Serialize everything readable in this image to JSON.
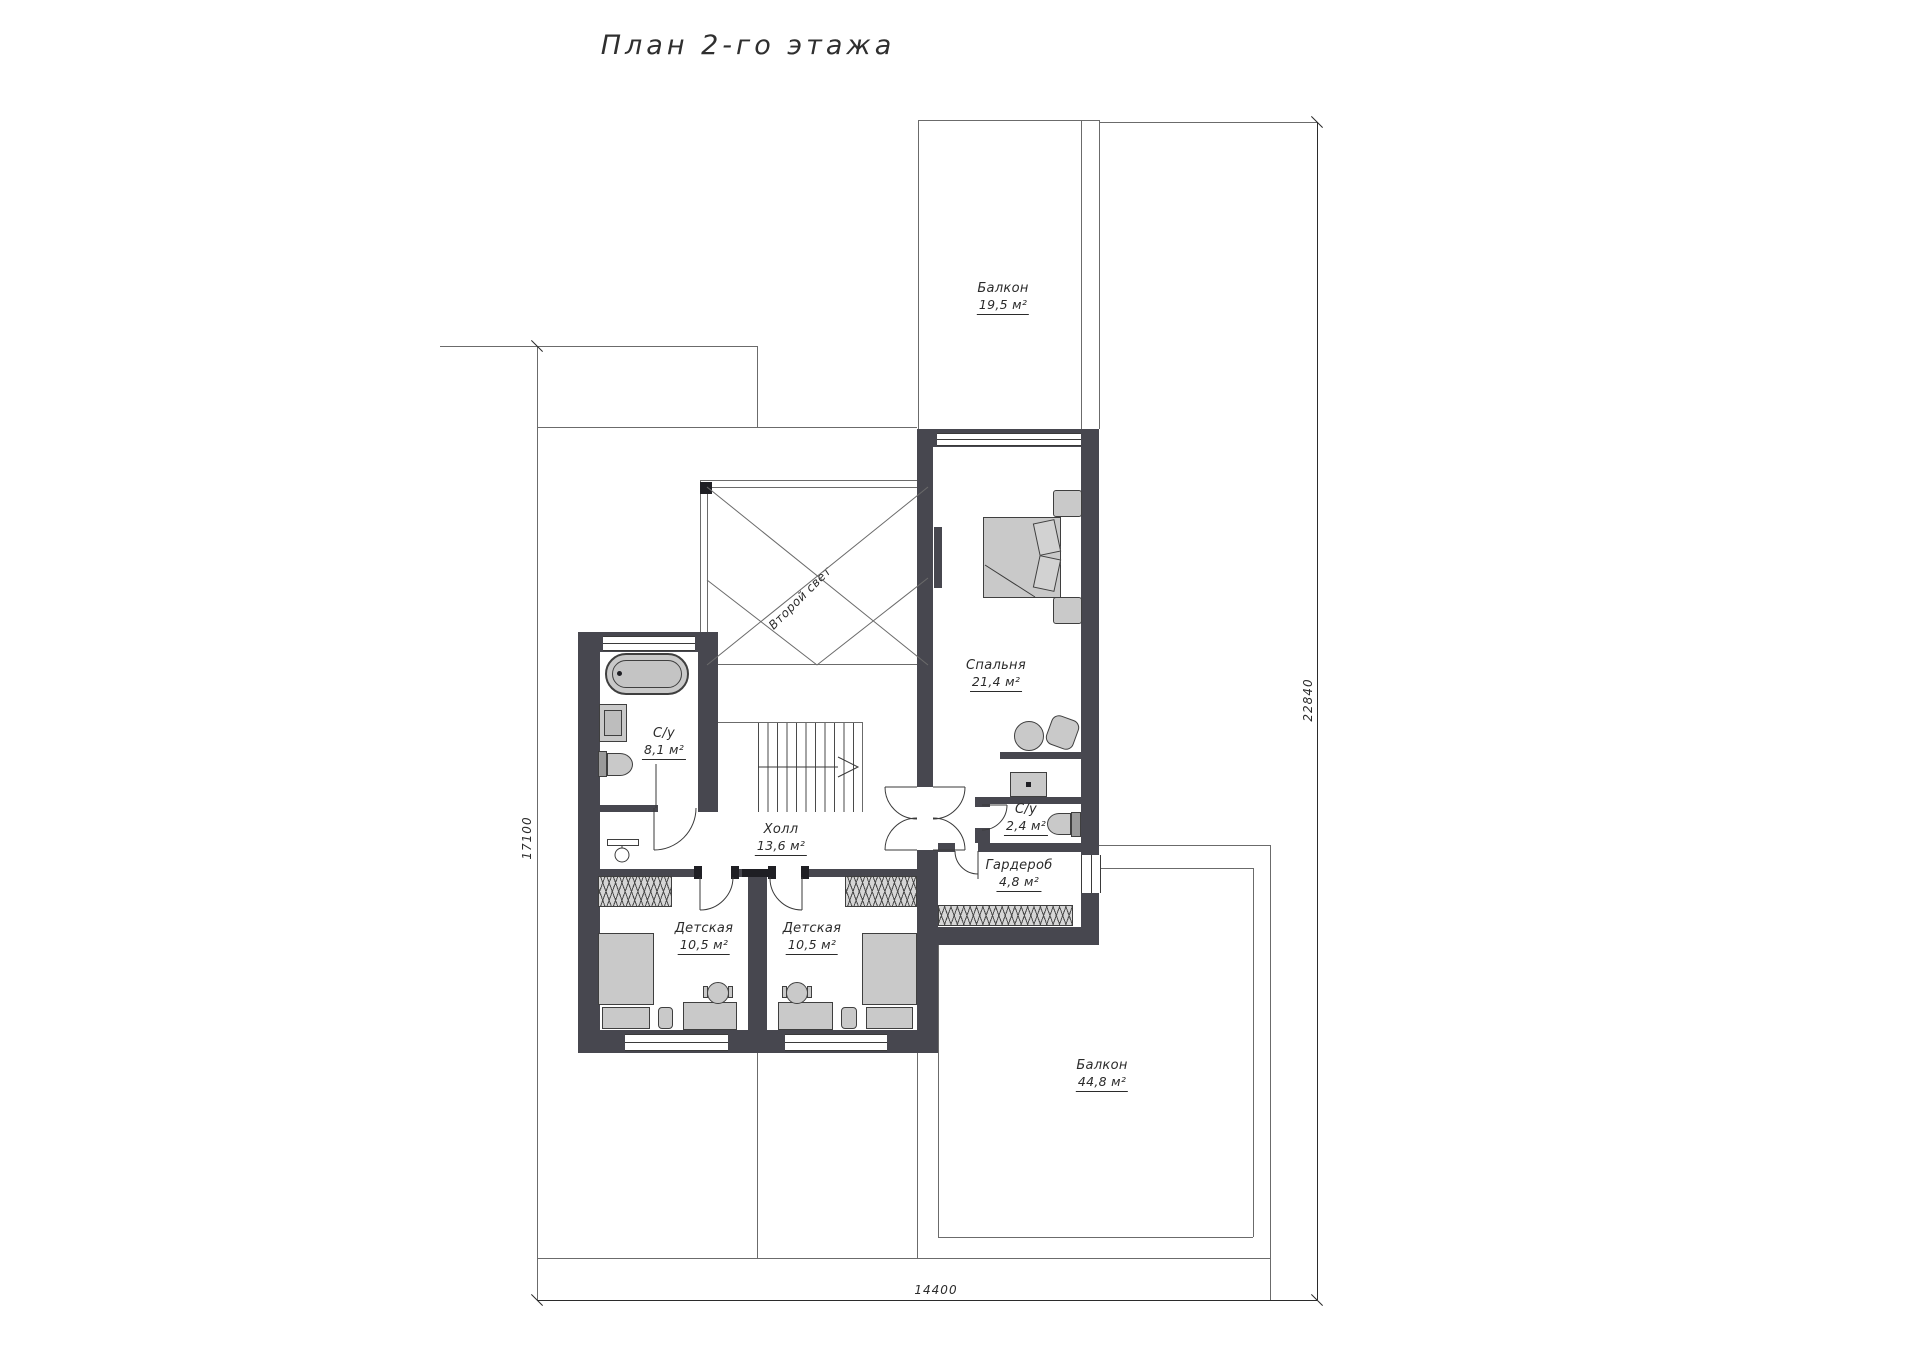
{
  "title": "План 2-го этажа",
  "rooms": {
    "balcony_top": {
      "name": "Балкон",
      "area": "19,5 м²"
    },
    "bedroom": {
      "name": "Спальня",
      "area": "21,4 м²"
    },
    "bath_main": {
      "name": "С/у",
      "area": "8,1 м²"
    },
    "hall": {
      "name": "Холл",
      "area": "13,6 м²"
    },
    "bath_small": {
      "name": "С/у",
      "area": "2,4 м²"
    },
    "wardrobe": {
      "name": "Гардероб",
      "area": "4,8 м²"
    },
    "kids1": {
      "name": "Детская",
      "area": "10,5 м²"
    },
    "kids2": {
      "name": "Детская",
      "area": "10,5 м²"
    },
    "balcony_bottom": {
      "name": "Балкон",
      "area": "44,8 м²"
    }
  },
  "annotations": {
    "second_light": "Второй свет"
  },
  "dimensions": {
    "right": "22840",
    "left": "17100",
    "bottom": "14400"
  },
  "colors": {
    "wall": "#47474f",
    "furniture": "#c9c9c9",
    "line": "#6b6b6b",
    "text": "#2b2b2b"
  }
}
